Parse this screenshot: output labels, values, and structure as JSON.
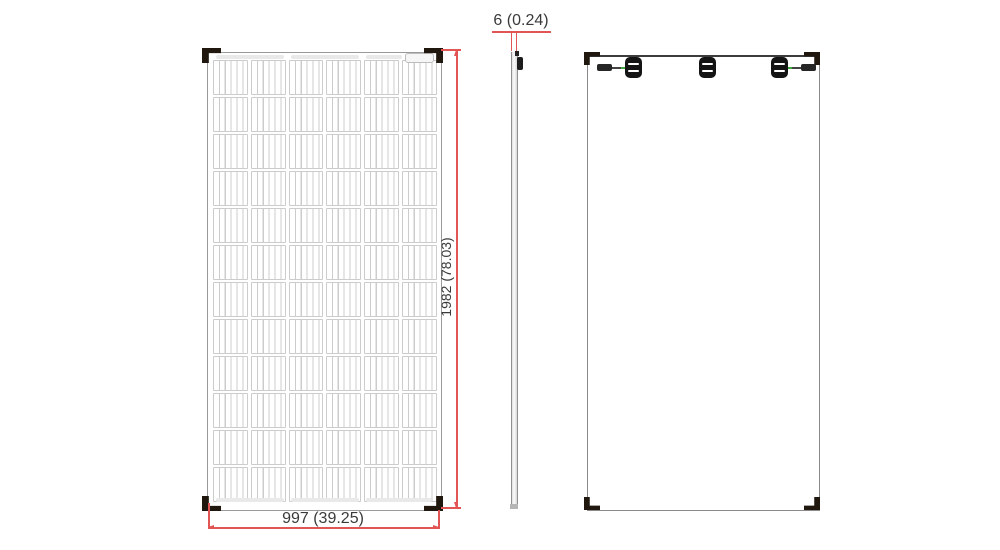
{
  "drawing": {
    "type": "solar panel mechanical dimension drawing",
    "dimensions": {
      "width_label": "997 (39.25)",
      "height_label": "1982 (78.03)",
      "thickness_label": "6 (0.24)"
    },
    "front": {
      "grid": {
        "rows": 12,
        "cols": 6
      }
    },
    "back": {
      "junction_box_count": 3
    },
    "colors": {
      "dimension_red": "#e25555",
      "frame_gray": "#9a9a9a",
      "cell_gray": "#cccccc",
      "bracket_black": "#20180f",
      "cable_green": "#3faa3f"
    }
  }
}
